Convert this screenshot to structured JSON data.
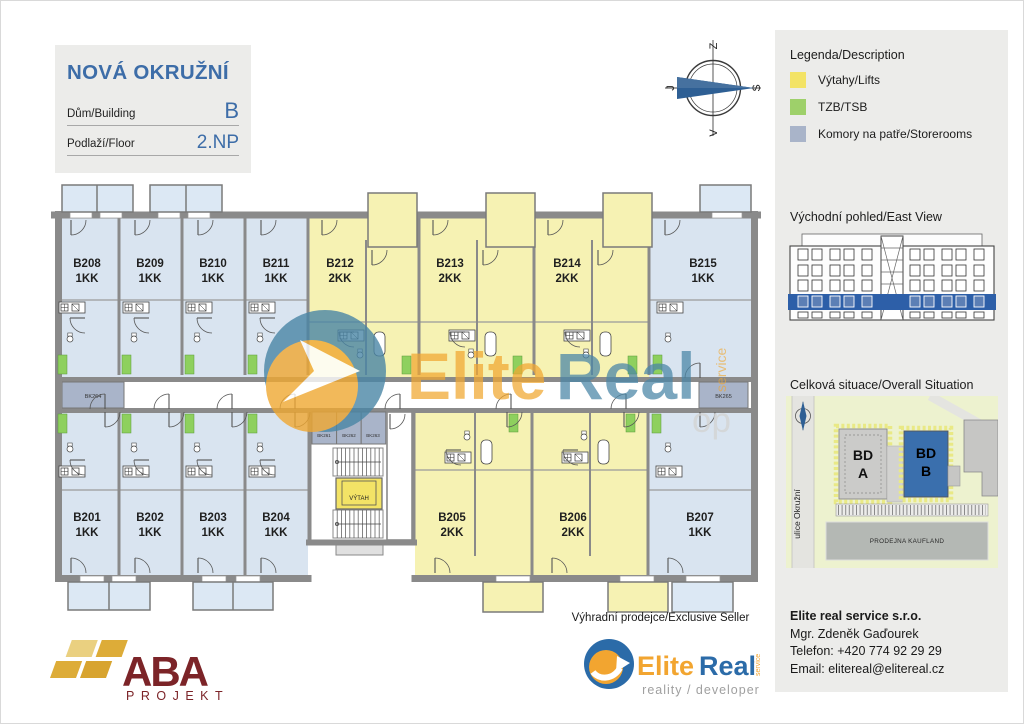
{
  "title_block": {
    "project": "NOVÁ OKRUŽNÍ",
    "building_label": "Dům/Building",
    "building_value": "B",
    "floor_label": "Podlaží/Floor",
    "floor_value": "2.NP"
  },
  "compass": {
    "top": "Z",
    "right": "S",
    "bottom": "V",
    "left": "J"
  },
  "legend": {
    "title": "Legenda/Description",
    "items": [
      {
        "label": "Výtahy/Lifts",
        "color": "#f3e366"
      },
      {
        "label": "TZB/TSB",
        "color": "#9ed06a"
      },
      {
        "label": "Komory na patře/Storerooms",
        "color": "#a9b4c9"
      }
    ]
  },
  "east_view": {
    "title": "Východní pohled/East View",
    "highlight_color": "#2d5fa8"
  },
  "situation": {
    "title": "Celková situace/Overall Situation",
    "street_label": "ulice Okružní",
    "building_a": {
      "line1": "BD",
      "line2": "A"
    },
    "building_b": {
      "line1": "BD",
      "line2": "B"
    },
    "store_label": "PRODEJNA KAUFLAND",
    "highlight_color": "#3a6fad"
  },
  "plan": {
    "units": [
      {
        "code": "B208",
        "type": "1KK"
      },
      {
        "code": "B209",
        "type": "1KK"
      },
      {
        "code": "B210",
        "type": "1KK"
      },
      {
        "code": "B211",
        "type": "1KK"
      },
      {
        "code": "B212",
        "type": "2KK"
      },
      {
        "code": "B213",
        "type": "2KK"
      },
      {
        "code": "B214",
        "type": "2KK"
      },
      {
        "code": "B215",
        "type": "1KK"
      },
      {
        "code": "B201",
        "type": "1KK"
      },
      {
        "code": "B202",
        "type": "1KK"
      },
      {
        "code": "B203",
        "type": "1KK"
      },
      {
        "code": "B204",
        "type": "1KK"
      },
      {
        "code": "B205",
        "type": "2KK"
      },
      {
        "code": "B206",
        "type": "2KK"
      },
      {
        "code": "B207",
        "type": "1KK"
      }
    ],
    "storerooms": {
      "bk261": "BK261",
      "bk262": "BK262",
      "bk263": "BK263",
      "bk264": "BK264",
      "bk265": "BK265"
    },
    "lift_label": "VÝTAH",
    "colors": {
      "unit_1kk": "#d9e4f0",
      "unit_2kk": "#f6f2b3",
      "walls": "#8a8a8a",
      "tzb": "#8ed05e",
      "storeroom": "#a9b4c9",
      "lift": "#f3e366"
    }
  },
  "watermark": {
    "part1": "Elite",
    "part2": "Real",
    "service": "service",
    "fragment": "op"
  },
  "seller": {
    "heading": "Výhradní prodejce/Exclusive Seller",
    "brand_part1": "Elite",
    "brand_part2": "Real",
    "brand_service": "service",
    "brand_tagline": "reality / developer",
    "company": "Elite real service s.r.o.",
    "contact": "Mgr. Zdeněk Gaďourek",
    "phone": "Telefon: +420 774 92 29 29",
    "email": "Email: elitereal@elitereal.cz"
  },
  "aba": {
    "name": "ABA",
    "sub": "PROJEKT"
  }
}
